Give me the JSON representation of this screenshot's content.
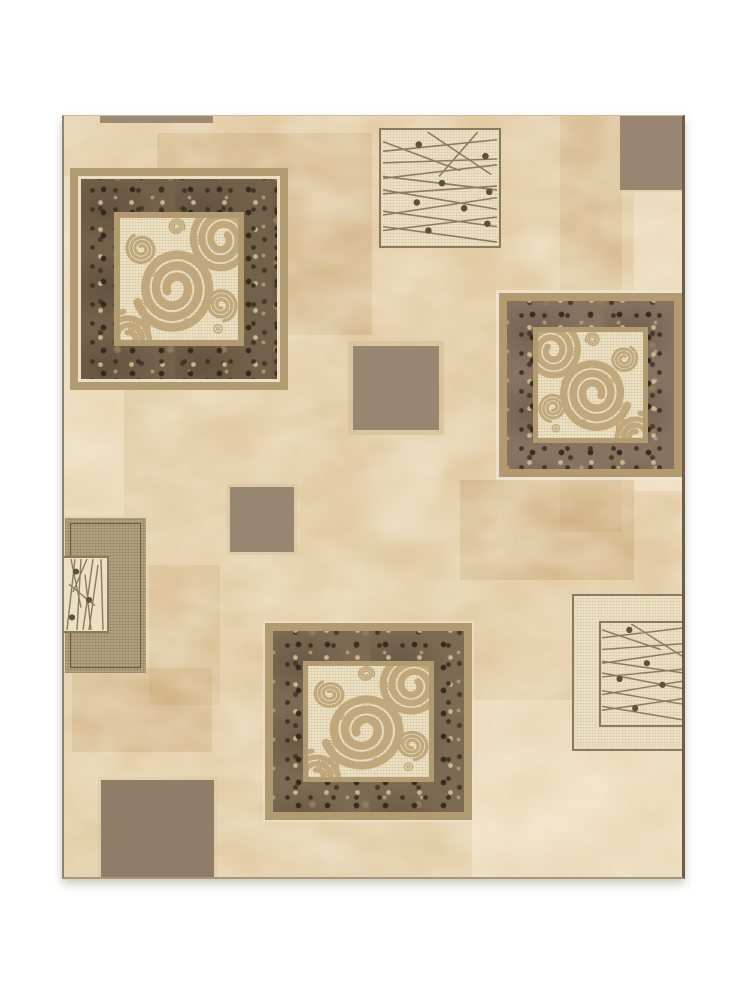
{
  "image": {
    "type": "product-photo",
    "alt": "Beige and brown abstract area rug with patchwork squares, ornate speckle-framed spiral panels, and cream panels of crossing lines with dots"
  },
  "palette": {
    "page_bg": "#ffffff",
    "rug_base": "#e2c9a1",
    "vein_light": "#f3e6c6",
    "vein_dark": "#c49f6e",
    "taupe": "#998671",
    "taupe_dark": "#8f7d68",
    "taupe_bar": "#9b8a74",
    "tan_frame": "#b29b71",
    "pale_line": "#eadfc2",
    "mottled_base": "#74614b",
    "cream_panel": "#ece1c3",
    "spiral": "#c1a87c",
    "line_color": "#8b7b60",
    "dot_color": "#5f4f3c",
    "box_border": "#8a7a5e",
    "weave_base": "#b2a17f",
    "edge_left": "#8d8274",
    "edge_right": "#6e5c44",
    "shadow": "rgba(130,118,98,0.40)"
  },
  "motifs": {
    "ornate_spiral_squares": [
      "top-left",
      "middle-right",
      "bottom-center"
    ],
    "line_dot_panels": [
      "top-center",
      "left-middle",
      "bottom-right"
    ],
    "plain_taupe_squares": [
      "top-edge-bar",
      "top-right",
      "center",
      "center-left-small",
      "bottom-left"
    ],
    "woven_squares": [
      "left-edge"
    ]
  }
}
